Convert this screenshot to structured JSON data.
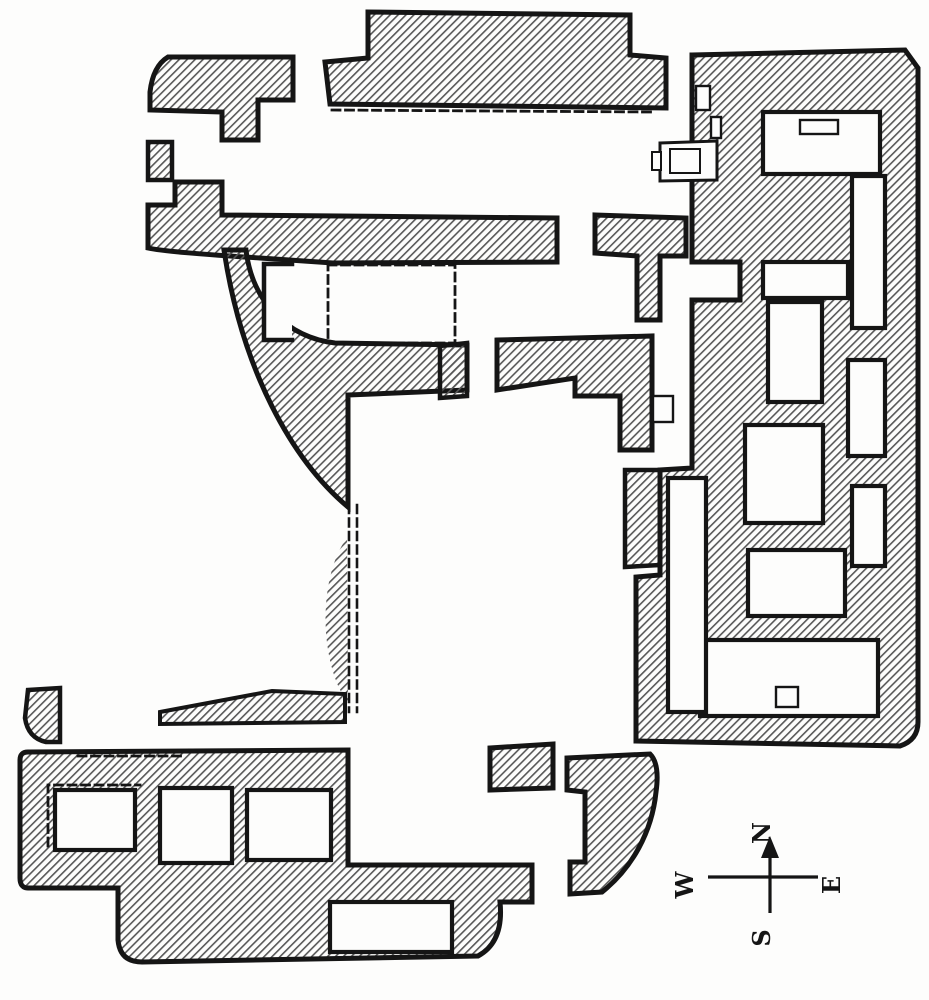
{
  "figure": {
    "kind": "engraved archaeological floor plan",
    "description": "Excavated palace ground plan with hatched wall masses, white rooms, dashed restored walls and a compass cross; plan printed sideways (compass letters rotated)"
  },
  "canvas": {
    "width": 929,
    "height": 1000
  },
  "palette": {
    "paper": "#fdfdfc",
    "ink": "#151515",
    "hatch_line": "#575757"
  },
  "hatch": {
    "tile": 5.6,
    "line_width": 1.6,
    "angle_deg": -45
  },
  "shapes": [
    {
      "name": "top-hall-north-wall",
      "kind": "path",
      "d": "M325,62 L368,58 L368,12 L630,15 L630,55 L666,58 L666,108 L330,104 Z",
      "fill": "hatch",
      "stroke": 5
    },
    {
      "name": "northwest-room-wall",
      "kind": "path",
      "d": "M168,57 L293,57 L293,100 L258,100 L258,140 L222,140 L222,112 L150,110 L150,92 Q153,66 168,57 Z",
      "fill": "hatch",
      "stroke": 5
    },
    {
      "name": "west-wall-block",
      "kind": "path",
      "d": "M148,142 L172,142 L172,180 L148,180 Z",
      "fill": "hatch",
      "stroke": 4.5
    },
    {
      "name": "long-west-wall-band",
      "kind": "path",
      "d": "M148,205 L175,205 L175,182 L222,182 L222,215 L557,218 L557,262 L333,263 L260,258 Q165,252 148,248 Z",
      "fill": "hatch",
      "stroke": 5
    },
    {
      "name": "west-wedge-wall",
      "kind": "path",
      "d": "M224,250 C242,370 292,460 348,507 L348,395 L467,390 L467,345 L335,343 C288,338 252,302 246,250 Z",
      "fill": "hatch",
      "stroke": 5
    },
    {
      "name": "court-junction-wall",
      "kind": "path",
      "d": "M595,215 L686,218 L686,256 L660,256 L660,320 L637,320 L637,256 L595,253 Z",
      "fill": "hatch",
      "stroke": 5
    },
    {
      "name": "central-t-wall",
      "kind": "path",
      "d": "M497,340 L652,336 L652,450 L620,450 L620,396 L575,396 L575,378 L497,390 Z",
      "fill": "hatch",
      "stroke": 5
    },
    {
      "name": "central-t-wall-west-stub",
      "kind": "path",
      "d": "M440,346 L467,343 L467,396 L440,398 Z",
      "fill": "hatch",
      "stroke": 4.5
    },
    {
      "name": "mid-slope-wall",
      "kind": "path",
      "d": "M347,538 C326,565 318,625 334,675 C339,690 344,697 348,702 Z",
      "fill": "hatch",
      "stroke": 0
    },
    {
      "name": "southwest-link-wall",
      "kind": "path",
      "d": "M160,712 L272,691 L345,694 L345,722 L160,724 Z",
      "fill": "hatch",
      "stroke": 4
    },
    {
      "name": "east-wing-wall",
      "kind": "path",
      "d": "M692,55 L905,50 L918,68 L918,722 Q918,740 900,746 L636,741 L636,577 L660,575 L660,470 L692,468 L692,300 L740,300 L740,262 L692,262 Z",
      "fill": "hatch",
      "stroke": 5
    },
    {
      "name": "east-court-bar-wall",
      "kind": "path",
      "d": "M625,470 L660,470 L660,565 L625,567 Z",
      "fill": "hatch",
      "stroke": 4.5
    },
    {
      "name": "south-complex-wall",
      "kind": "path",
      "d": "M28,752 L348,750 L348,865 L532,865 L532,902 L500,902 Q504,942 478,956 L142,962 Q120,962 118,940 L118,888 L28,888 Q20,888 20,878 L20,760 Q20,752 28,752 Z",
      "fill": "hatch",
      "stroke": 5
    },
    {
      "name": "south-corner-fragment",
      "kind": "path",
      "d": "M28,690 L60,688 L60,742 L46,742 Q28,738 25,718 Z",
      "fill": "hatch",
      "stroke": 4.5
    },
    {
      "name": "south-detached-block",
      "kind": "path",
      "d": "M490,748 L553,744 L553,788 L490,790 Z",
      "fill": "hatch",
      "stroke": 5
    },
    {
      "name": "south-east-wedge-wall",
      "kind": "path",
      "d": "M567,758 L650,754 Q660,764 656,792 C652,832 632,868 602,892 L570,894 L570,862 L585,862 L585,792 L567,790 Z",
      "fill": "hatch",
      "stroke": 5
    },
    {
      "name": "wedge-slot-room",
      "kind": "rect",
      "x": 264,
      "y": 264,
      "w": 28,
      "h": 76,
      "fill": "paper",
      "stroke": 0
    },
    {
      "name": "wedge-slot-wall",
      "kind": "path",
      "d": "M292,264 L264,264 L264,340 L292,340",
      "fill": "none",
      "stroke": 4.5
    },
    {
      "name": "ne-corner-room",
      "kind": "rect",
      "x": 763,
      "y": 112,
      "w": 117,
      "h": 62,
      "fill": "paper",
      "stroke": 4.2
    },
    {
      "name": "ne-room-threshold",
      "kind": "rect",
      "x": 800,
      "y": 120,
      "w": 38,
      "h": 14,
      "fill": "paper",
      "stroke": 2.4
    },
    {
      "name": "wall-niche-a",
      "kind": "rect",
      "x": 711,
      "y": 117,
      "w": 10,
      "h": 21,
      "fill": "paper",
      "stroke": 2.4
    },
    {
      "name": "wall-niche-b",
      "kind": "rect",
      "x": 696,
      "y": 86,
      "w": 14,
      "h": 24,
      "fill": "paper",
      "stroke": 2.4
    },
    {
      "name": "east-room-1",
      "kind": "rect",
      "x": 763,
      "y": 262,
      "w": 85,
      "h": 36,
      "fill": "paper",
      "stroke": 4.2
    },
    {
      "name": "east-corridor-upper",
      "kind": "rect",
      "x": 852,
      "y": 176,
      "w": 33,
      "h": 152,
      "fill": "paper",
      "stroke": 4.2
    },
    {
      "name": "east-room-2",
      "kind": "rect",
      "x": 768,
      "y": 302,
      "w": 54,
      "h": 100,
      "fill": "paper",
      "stroke": 4.2
    },
    {
      "name": "east-room-3",
      "kind": "rect",
      "x": 848,
      "y": 360,
      "w": 37,
      "h": 96,
      "fill": "paper",
      "stroke": 4.2
    },
    {
      "name": "east-room-4",
      "kind": "rect",
      "x": 745,
      "y": 425,
      "w": 78,
      "h": 98,
      "fill": "paper",
      "stroke": 4.2
    },
    {
      "name": "east-corridor-mid",
      "kind": "rect",
      "x": 852,
      "y": 486,
      "w": 33,
      "h": 80,
      "fill": "paper",
      "stroke": 4.2
    },
    {
      "name": "east-room-5",
      "kind": "rect",
      "x": 748,
      "y": 550,
      "w": 97,
      "h": 66,
      "fill": "paper",
      "stroke": 4.2
    },
    {
      "name": "east-room-6",
      "kind": "rect",
      "x": 700,
      "y": 640,
      "w": 178,
      "h": 76,
      "fill": "paper",
      "stroke": 4.2
    },
    {
      "name": "se-threshold",
      "kind": "rect",
      "x": 776,
      "y": 687,
      "w": 22,
      "h": 20,
      "fill": "paper",
      "stroke": 2.4
    },
    {
      "name": "east-west-corridor",
      "kind": "rect",
      "x": 668,
      "y": 478,
      "w": 38,
      "h": 234,
      "fill": "paper",
      "stroke": 4.2
    },
    {
      "name": "central-threshold",
      "kind": "rect",
      "x": 653,
      "y": 396,
      "w": 20,
      "h": 26,
      "fill": "paper",
      "stroke": 2.4
    },
    {
      "name": "south-room-1",
      "kind": "rect",
      "x": 55,
      "y": 790,
      "w": 80,
      "h": 60,
      "fill": "paper",
      "stroke": 4.2
    },
    {
      "name": "south-room-2",
      "kind": "rect",
      "x": 160,
      "y": 788,
      "w": 72,
      "h": 75,
      "fill": "paper",
      "stroke": 4.2
    },
    {
      "name": "south-room-3",
      "kind": "rect",
      "x": 247,
      "y": 790,
      "w": 84,
      "h": 70,
      "fill": "paper",
      "stroke": 4.2
    },
    {
      "name": "south-room-4",
      "kind": "rect",
      "x": 330,
      "y": 902,
      "w": 122,
      "h": 50,
      "fill": "paper",
      "stroke": 4.2
    },
    {
      "name": "hearth-outer",
      "kind": "path",
      "d": "M660,143 L717,141 L717,180 L660,181 Z",
      "fill": "paper",
      "stroke": 3
    },
    {
      "name": "hearth-inner",
      "kind": "rect",
      "x": 670,
      "y": 149,
      "w": 30,
      "h": 24,
      "fill": "none",
      "stroke": 2
    },
    {
      "name": "hearth-step",
      "kind": "rect",
      "x": 652,
      "y": 152,
      "w": 9,
      "h": 18,
      "fill": "paper",
      "stroke": 2
    },
    {
      "name": "restored-wall-north",
      "kind": "path",
      "d": "M332,110 L652,112",
      "fill": "none",
      "stroke": 2.8,
      "dash": "8 5.5"
    },
    {
      "name": "restored-wall-court",
      "kind": "path",
      "d": "M328,265 L455,265 L455,343 L328,343 Z",
      "fill": "none",
      "stroke": 2.8,
      "dash": "8 5.5"
    },
    {
      "name": "restored-wall-mid-a",
      "kind": "path",
      "d": "M349,505 L349,712",
      "fill": "none",
      "stroke": 2.6,
      "dash": "8 5.5"
    },
    {
      "name": "restored-wall-mid-b",
      "kind": "path",
      "d": "M357,505 L357,712",
      "fill": "none",
      "stroke": 2.6,
      "dash": "8 5.5"
    },
    {
      "name": "restored-wall-south-a",
      "kind": "path",
      "d": "M78,756 L185,756",
      "fill": "none",
      "stroke": 2.8,
      "dash": "8 5.5"
    },
    {
      "name": "restored-wall-south-b",
      "kind": "path",
      "d": "M48,846 L48,785 L140,785",
      "fill": "none",
      "stroke": 2.8,
      "dash": "8 5.5"
    }
  ],
  "compass": {
    "lines": [
      {
        "name": "compass-ns-line",
        "d": "M770,845 L770,913"
      },
      {
        "name": "compass-ew-line",
        "d": "M708,877 L818,877"
      }
    ],
    "arrow": "770,836 761,858 779,858",
    "line_width": 3.2,
    "font_size": 24,
    "label_rotation_deg": -90,
    "labels": [
      {
        "name": "compass-label-n",
        "text": "N",
        "x": 770,
        "y": 833
      },
      {
        "name": "compass-label-s",
        "text": "S",
        "x": 770,
        "y": 938
      },
      {
        "name": "compass-label-w",
        "text": "W",
        "x": 693,
        "y": 885
      },
      {
        "name": "compass-label-e",
        "text": "E",
        "x": 840,
        "y": 885
      }
    ]
  }
}
